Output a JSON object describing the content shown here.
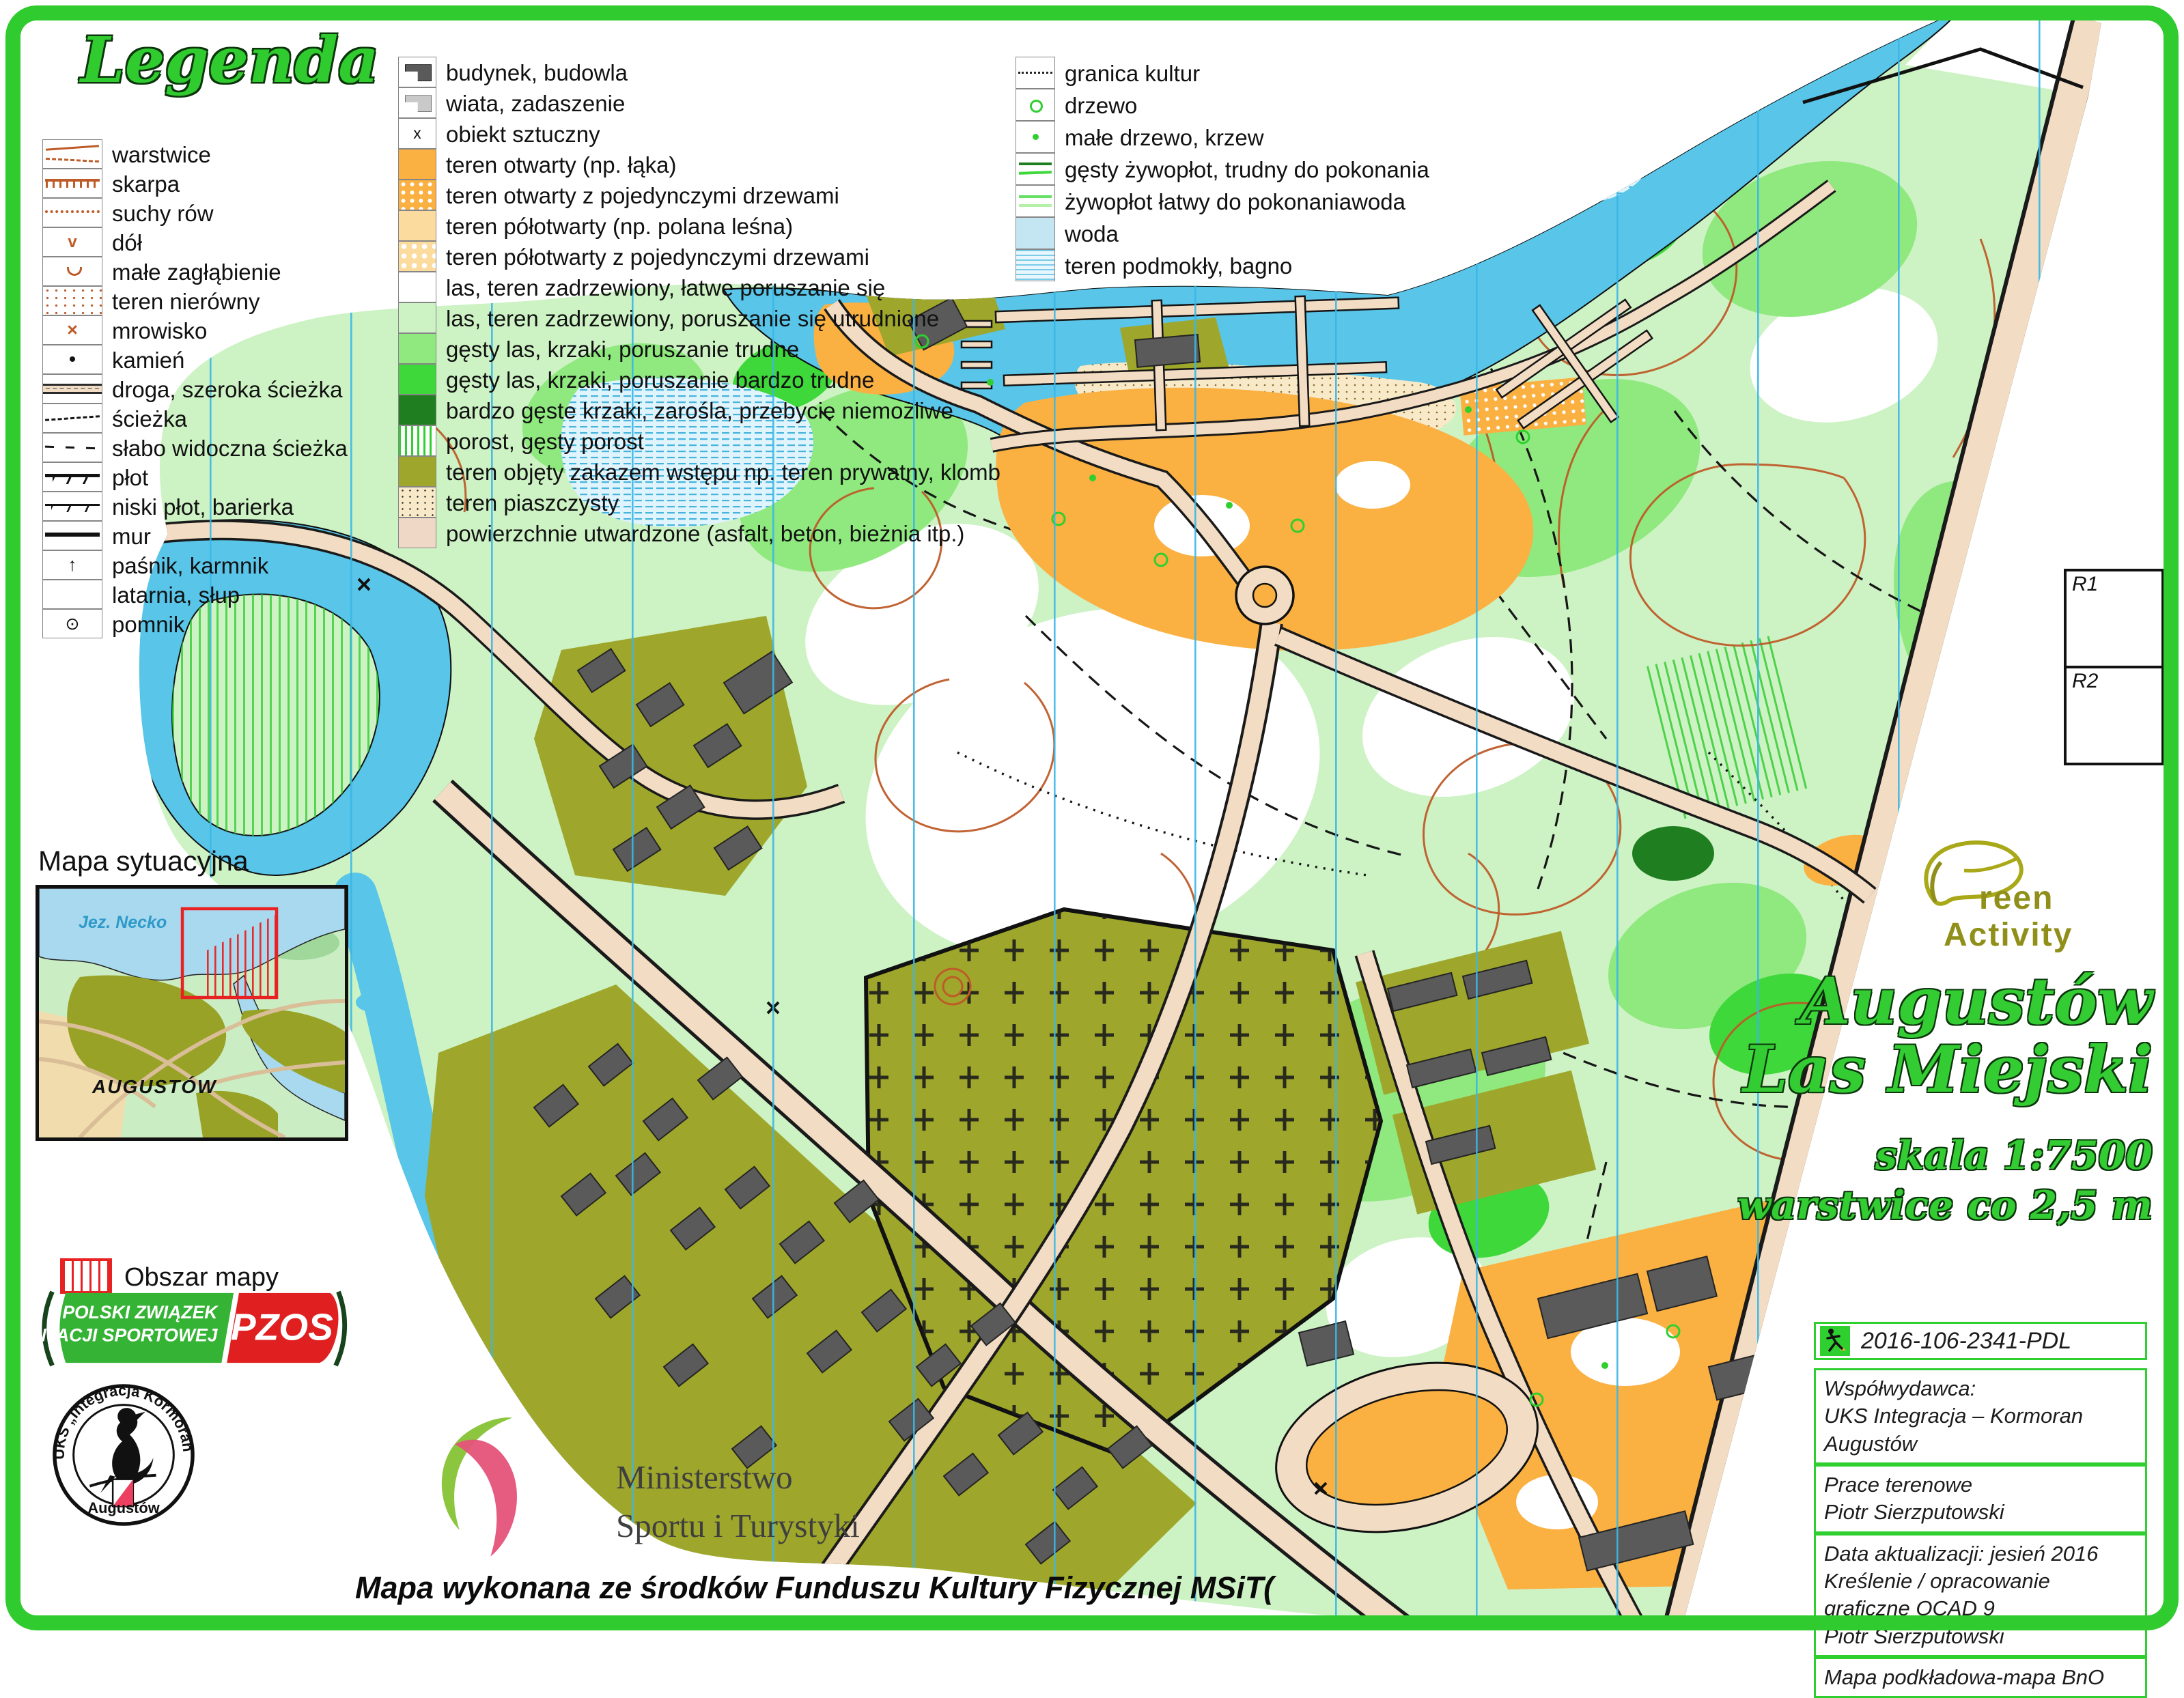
{
  "legend": {
    "title": "Legenda",
    "col1": [
      {
        "sym": "warstwice",
        "label": "warstwice"
      },
      {
        "sym": "skarpa",
        "label": "skarpa"
      },
      {
        "sym": "suchy-row",
        "label": "suchy rów"
      },
      {
        "sym": "dol",
        "label": "dół",
        "glyph": "v"
      },
      {
        "sym": "zaglebienie",
        "label": "małe zagłąbienie"
      },
      {
        "sym": "nierowny",
        "label": "teren nierówny"
      },
      {
        "sym": "mrowisko",
        "label": "mrowisko",
        "glyph": "×"
      },
      {
        "sym": "kamien",
        "label": "kamień",
        "glyph": "•"
      },
      {
        "sym": "droga",
        "label": "droga, szeroka ścieżka"
      },
      {
        "sym": "sciezka",
        "label": "ścieżka"
      },
      {
        "sym": "slaba-sciezka",
        "label": "słabo widoczna ścieżka"
      },
      {
        "sym": "plot",
        "label": "płot"
      },
      {
        "sym": "niski-plot",
        "label": "niski płot, barierka"
      },
      {
        "sym": "mur",
        "label": "mur"
      },
      {
        "sym": "pasnik",
        "label": "paśnik, karmnik",
        "glyph": "↑"
      },
      {
        "sym": "latarnia",
        "label": "latarnia, słup"
      },
      {
        "sym": "pomnik",
        "label": "pomnik",
        "glyph": "⊙"
      }
    ],
    "col2": [
      {
        "sym": "budynek",
        "label": "budynek, budowla"
      },
      {
        "sym": "wiata",
        "label": "wiata, zadaszenie"
      },
      {
        "sym": "obiekt",
        "label": "obiekt sztuczny",
        "glyph": "x"
      },
      {
        "sym": "otwarty",
        "label": "teren otwarty (np. łąka)"
      },
      {
        "sym": "otwarty-drzewa",
        "label": "teren otwarty z pojedynczymi drzewami"
      },
      {
        "sym": "polotwarty",
        "label": "teren półotwarty (np. polana leśna)"
      },
      {
        "sym": "polotwarty-drzewa",
        "label": "teren półotwarty z pojedynczymi drzewami"
      },
      {
        "sym": "las-latwy",
        "label": "las, teren zadrzewiony, łatwe poruszanie się"
      },
      {
        "sym": "las-utrudniony",
        "label": "las, teren zadrzewiony, poruszanie się utrudnione"
      },
      {
        "sym": "las-trudny",
        "label": "gęsty las, krzaki, poruszanie trudne"
      },
      {
        "sym": "las-btrudny",
        "label": "gęsty las, krzaki, poruszanie bardzo trudne"
      },
      {
        "sym": "bgeste",
        "label": "bardzo gęste krzaki, zarośla, przebycie niemożliwe"
      },
      {
        "sym": "porost",
        "label": "porost, gęsty porost"
      },
      {
        "sym": "zakaz",
        "label": "teren objęty zakazem wstępu np. teren prywatny, klomb"
      },
      {
        "sym": "piasek",
        "label": "teren piaszczysty"
      },
      {
        "sym": "utwardzone",
        "label": "powierzchnie utwardzone (asfalt, beton, bieżnia itp.)"
      }
    ],
    "col3": [
      {
        "sym": "granica",
        "label": "granica kultur"
      },
      {
        "sym": "drzewo",
        "label": "drzewo"
      },
      {
        "sym": "male-drzewo",
        "label": "małe drzewo, krzew"
      },
      {
        "sym": "zywoplot-gesty",
        "label": "gęsty żywopłot, trudny do pokonania"
      },
      {
        "sym": "zywoplot-latwy",
        "label": "żywopłot łatwy do pokonaniawoda"
      },
      {
        "sym": "woda",
        "label": "woda"
      },
      {
        "sym": "bagno",
        "label": "teren podmokły, bagno"
      }
    ]
  },
  "situational": {
    "heading": "Mapa sytuacyjna",
    "lake_label": "Jez. Necko",
    "city_label": "AUGUSTÓW",
    "area_label": "Obszar mapy"
  },
  "title_block": {
    "line1": "Augustów",
    "line2": "Las Miejski",
    "scale": "skala 1:7500",
    "contours": "warstwice co 2,5 m"
  },
  "green_activity": {
    "line1": "reen",
    "line2": "Activity"
  },
  "registration_boxes": {
    "r1": "R1",
    "r2": "R2"
  },
  "credits": {
    "code_box": {
      "code": "2016-106-2341-PDL",
      "icon": "orienteering-runner"
    },
    "boxes": [
      {
        "lines": [
          "Współwydawca:",
          "UKS Integracja – Kormoran Augustów"
        ]
      },
      {
        "lines": [
          "Prace terenowe",
          "Piotr Sierzputowski"
        ]
      },
      {
        "lines": [
          "Data aktualizacji: jesień 2016",
          "Kreślenie / opracowanie graficzne OCAD 9",
          "Piotr Sierzputowski"
        ]
      },
      {
        "lines": [
          "Mapa podkładowa-mapa BnO"
        ]
      }
    ]
  },
  "logos": {
    "pzos": {
      "line1": "POLSKI ZWIĄZEK",
      "line2": "ORIENTACJI SPORTOWEJ",
      "abbr": "PZOS"
    },
    "kormoran": {
      "ring_top": "UKS „Integracja Kormoran”",
      "ring_bottom": "Augustów"
    },
    "ministry": {
      "line1": "Ministerstwo",
      "line2": "Sportu i Turystyki"
    }
  },
  "footer": "Mapa wykonana ze środków Funduszu Kultury Fizycznej MSiT(",
  "colors": {
    "frame_green": "#2FCB2F",
    "title_green": "#33CC33",
    "water_blue": "#58C5E9",
    "open_orange": "#FBB042",
    "restricted_olive": "#9EA72B",
    "contour_brown": "#BE5B28",
    "north_line_blue": "#3AB7E6",
    "map_area_red": "#E82222",
    "pzos_green": "#35B335",
    "pzos_red": "#E02020"
  }
}
